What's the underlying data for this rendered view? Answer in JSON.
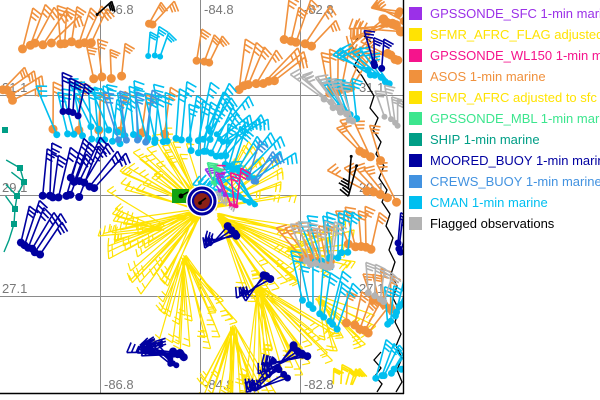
{
  "colors": {
    "sfc": "#9B30E8",
    "sfmr_flag": "#FFE303",
    "wl150": "#F5148C",
    "asos": "#F0913D",
    "sfmr": "#FFE303",
    "mbl": "#3CE68E",
    "ship": "#009E86",
    "moored": "#0000A0",
    "crews": "#4292E0",
    "cman": "#00BFF0",
    "flag": "#B3B3B3",
    "black": "#000000",
    "grid": "#8A8A8A",
    "axis_text": "#787878",
    "map_border": "#000000",
    "eye_core": "#8B2016",
    "green_box": "#12A312"
  },
  "legend": {
    "items": [
      {
        "key": "sfc",
        "label": "GPSSONDE_SFC 1-min marine"
      },
      {
        "key": "sfmr_flag",
        "label": "SFMR_AFRC_FLAG adjusted to"
      },
      {
        "key": "wl150",
        "label": "GPSSONDE_WL150 1-min mar"
      },
      {
        "key": "asos",
        "label": "ASOS 1-min marine"
      },
      {
        "key": "sfmr",
        "label": "SFMR_AFRC adjusted to sfc"
      },
      {
        "key": "mbl",
        "label": "GPSSONDE_MBL 1-min marine"
      },
      {
        "key": "ship",
        "label": "SHIP 1-min marine"
      },
      {
        "key": "moored",
        "label": "MOORED_BUOY 1-min marine"
      },
      {
        "key": "crews",
        "label": "CREWS_BUOY 1-min marine"
      },
      {
        "key": "cman",
        "label": "CMAN 1-min marine"
      },
      {
        "key": "flag",
        "label": "Flagged observations",
        "text_color": "#000000"
      }
    ]
  },
  "map": {
    "width": 403,
    "height": 393,
    "grid_v": [
      {
        "x": 100,
        "label": "-86.8"
      },
      {
        "x": 200,
        "label": "-84.8"
      },
      {
        "x": 300,
        "label": "-82.8"
      }
    ],
    "grid_h": [
      {
        "y": 95,
        "label": "31.1"
      },
      {
        "y": 195,
        "label": "29.1"
      },
      {
        "y": 296,
        "label": "27.1"
      }
    ],
    "clusters": [
      {
        "c": "asos",
        "x": 22,
        "y": 47,
        "n": 5,
        "dir": -62,
        "spread": 28,
        "len": 40,
        "dx": 7,
        "dy": -1,
        "dot": 4.5
      },
      {
        "c": "asos",
        "x": 60,
        "y": 42,
        "n": 6,
        "dir": -78,
        "spread": 30,
        "len": 38,
        "dx": 6,
        "dy": 0,
        "dot": 4.5
      },
      {
        "c": "asos",
        "x": 93,
        "y": 77,
        "n": 4,
        "dir": -95,
        "spread": 22,
        "len": 34,
        "dx": 9,
        "dy": 0,
        "dot": 4.5
      },
      {
        "c": "asos",
        "x": 2,
        "y": 88,
        "n": 4,
        "dir": -35,
        "spread": 25,
        "len": 34,
        "dx": 4,
        "dy": 4,
        "dot": 4.5
      },
      {
        "c": "asos",
        "x": 148,
        "y": 22,
        "n": 2,
        "dir": -52,
        "spread": 16,
        "len": 28,
        "dx": 6,
        "dy": 2,
        "dot": 4
      },
      {
        "c": "asos",
        "x": 238,
        "y": 88,
        "n": 7,
        "dir": -57,
        "spread": 46,
        "len": 45,
        "dx": 6,
        "dy": -1,
        "dot": 4.5
      },
      {
        "c": "asos",
        "x": 283,
        "y": 38,
        "n": 5,
        "dir": -68,
        "spread": 36,
        "len": 40,
        "dx": 7,
        "dy": 2,
        "dot": 4.5
      },
      {
        "c": "asos",
        "x": 328,
        "y": 92,
        "n": 6,
        "dir": -82,
        "spread": 40,
        "len": 40,
        "dx": 5,
        "dy": -1,
        "dot": 4
      },
      {
        "c": "asos",
        "x": 382,
        "y": 18,
        "n": 5,
        "dir": 162,
        "spread": 38,
        "len": 44,
        "dx": 5,
        "dy": 3,
        "dot": 5
      },
      {
        "c": "asos",
        "x": 386,
        "y": 52,
        "n": 4,
        "dir": -168,
        "spread": 28,
        "len": 40,
        "dx": 4,
        "dy": 3,
        "dot": 4.5
      },
      {
        "c": "asos",
        "x": 398,
        "y": 10,
        "n": 3,
        "dir": -165,
        "spread": 20,
        "len": 30,
        "dx": 2,
        "dy": 6,
        "dot": 4
      },
      {
        "c": "asos",
        "x": 358,
        "y": 150,
        "n": 4,
        "dir": -122,
        "spread": 26,
        "len": 38,
        "dx": 7,
        "dy": 3,
        "dot": 4.5
      },
      {
        "c": "asos",
        "x": 365,
        "y": 190,
        "n": 5,
        "dir": -135,
        "spread": 30,
        "len": 40,
        "dx": 8,
        "dy": 3,
        "dot": 4.5
      },
      {
        "c": "asos",
        "x": 55,
        "y": 128,
        "n": 6,
        "dir": -88,
        "spread": 10,
        "len": 44,
        "dx": 22,
        "dy": 1,
        "dot": 4.5
      },
      {
        "c": "asos",
        "x": 305,
        "y": 258,
        "n": 6,
        "dir": -115,
        "spread": 34,
        "len": 40,
        "dx": 5,
        "dy": 1,
        "dot": 4.5
      },
      {
        "c": "asos",
        "x": 350,
        "y": 243,
        "n": 5,
        "dir": -95,
        "spread": 30,
        "len": 36,
        "dx": 5,
        "dy": 2,
        "dot": 4.5
      },
      {
        "c": "asos",
        "x": 348,
        "y": 322,
        "n": 5,
        "dir": -70,
        "spread": 30,
        "len": 34,
        "dx": 5,
        "dy": 3,
        "dot": 4.5
      },
      {
        "c": "asos",
        "x": 374,
        "y": 300,
        "n": 4,
        "dir": -100,
        "spread": 24,
        "len": 32,
        "dx": 6,
        "dy": 3,
        "dot": 4
      },
      {
        "c": "asos",
        "x": 198,
        "y": 60,
        "n": 3,
        "dir": -72,
        "spread": 18,
        "len": 28,
        "dx": 6,
        "dy": 1,
        "dot": 4
      },
      {
        "c": "cman",
        "x": 58,
        "y": 134,
        "n": 9,
        "dir": -96,
        "spread": 30,
        "len": 48,
        "dx": 8,
        "dy": 1,
        "dot": 3.5
      },
      {
        "c": "cman",
        "x": 92,
        "y": 126,
        "n": 9,
        "dir": -102,
        "spread": 36,
        "len": 50,
        "dx": 8,
        "dy": 2,
        "dot": 3.5
      },
      {
        "c": "cman",
        "x": 148,
        "y": 140,
        "n": 10,
        "dir": -86,
        "spread": 40,
        "len": 52,
        "dx": 7,
        "dy": 0,
        "dot": 3.5
      },
      {
        "c": "cman",
        "x": 192,
        "y": 150,
        "n": 8,
        "dir": -70,
        "spread": 44,
        "len": 48,
        "dx": 5,
        "dy": 1,
        "dot": 3.5
      },
      {
        "c": "cman",
        "x": 226,
        "y": 164,
        "n": 8,
        "dir": -58,
        "spread": 50,
        "len": 44,
        "dx": 4,
        "dy": 2,
        "dot": 3.5
      },
      {
        "c": "cman",
        "x": 238,
        "y": 197,
        "n": 10,
        "dir": -148,
        "spread": 55,
        "len": 44,
        "dx": 2,
        "dy": 1,
        "dot": 2.5
      },
      {
        "c": "cman",
        "x": 303,
        "y": 300,
        "n": 8,
        "dir": -86,
        "spread": 36,
        "len": 45,
        "dx": 5,
        "dy": 4,
        "dot": 3.5
      },
      {
        "c": "cman",
        "x": 318,
        "y": 264,
        "n": 7,
        "dir": -96,
        "spread": 30,
        "len": 42,
        "dx": 5,
        "dy": -2,
        "dot": 3.5
      },
      {
        "c": "cman",
        "x": 388,
        "y": 324,
        "n": 6,
        "dir": -76,
        "spread": 30,
        "len": 36,
        "dx": 3,
        "dy": -4,
        "dot": 3.5
      },
      {
        "c": "cman",
        "x": 376,
        "y": 378,
        "n": 7,
        "dir": -60,
        "spread": 34,
        "len": 40,
        "dx": 5,
        "dy": -2,
        "dot": 3.5
      },
      {
        "c": "cman",
        "x": 368,
        "y": 70,
        "n": 6,
        "dir": -140,
        "spread": 34,
        "len": 40,
        "dx": 4,
        "dy": 3,
        "dot": 3.5
      },
      {
        "c": "cman",
        "x": 340,
        "y": 106,
        "n": 5,
        "dir": -112,
        "spread": 28,
        "len": 36,
        "dx": 4,
        "dy": 3,
        "dot": 3.5
      },
      {
        "c": "cman",
        "x": 148,
        "y": 56,
        "n": 3,
        "dir": -80,
        "spread": 18,
        "len": 28,
        "dx": 6,
        "dy": 1,
        "dot": 3
      },
      {
        "c": "cman",
        "x": 208,
        "y": 128,
        "n": 6,
        "dir": -46,
        "spread": 40,
        "len": 44,
        "dx": 4,
        "dy": 3,
        "dot": 3
      },
      {
        "c": "crews",
        "x": 118,
        "y": 140,
        "n": 4,
        "dir": -95,
        "spread": 24,
        "len": 46,
        "dx": 9,
        "dy": 1,
        "dot": 3.5
      },
      {
        "c": "crews",
        "x": 248,
        "y": 178,
        "n": 3,
        "dir": -60,
        "spread": 20,
        "len": 38,
        "dx": 5,
        "dy": 2,
        "dot": 3
      },
      {
        "c": "moored",
        "x": 42,
        "y": 196,
        "n": 7,
        "dir": -78,
        "spread": 18,
        "len": 48,
        "dx": 6,
        "dy": 0,
        "dot": 4
      },
      {
        "c": "moored",
        "x": 70,
        "y": 178,
        "n": 6,
        "dir": -60,
        "spread": 24,
        "len": 44,
        "dx": 5,
        "dy": 2,
        "dot": 4
      },
      {
        "c": "moored",
        "x": 20,
        "y": 243,
        "n": 6,
        "dir": -64,
        "spread": 22,
        "len": 42,
        "dx": 4,
        "dy": 2,
        "dot": 4
      },
      {
        "c": "moored",
        "x": 62,
        "y": 112,
        "n": 4,
        "dir": -86,
        "spread": 18,
        "len": 34,
        "dx": 5,
        "dy": 1,
        "dot": 3.5
      },
      {
        "c": "moored",
        "x": 172,
        "y": 352,
        "n": 6,
        "dir": 182,
        "spread": 10,
        "len": 42,
        "dx": 2,
        "dy": 1,
        "dot": 4
      },
      {
        "c": "moored",
        "x": 168,
        "y": 358,
        "n": 5,
        "dir": 215,
        "spread": 25,
        "len": 30,
        "dx": 2,
        "dy": 2,
        "dot": 3
      },
      {
        "c": "moored",
        "x": 272,
        "y": 362,
        "n": 5,
        "dir": 145,
        "spread": 30,
        "len": 38,
        "dx": 4,
        "dy": 4,
        "dot": 3.5
      },
      {
        "c": "moored",
        "x": 292,
        "y": 346,
        "n": 6,
        "dir": 148,
        "spread": 48,
        "len": 42,
        "dx": 3,
        "dy": 2,
        "dot": 4
      },
      {
        "c": "moored",
        "x": 262,
        "y": 276,
        "n": 3,
        "dir": 136,
        "spread": 24,
        "len": 34,
        "dx": 4,
        "dy": 2,
        "dot": 4
      },
      {
        "c": "moored",
        "x": 226,
        "y": 227,
        "n": 4,
        "dir": 150,
        "spread": 34,
        "len": 30,
        "dx": 4,
        "dy": 3,
        "dot": 4
      },
      {
        "c": "moored",
        "x": 372,
        "y": 64,
        "n": 3,
        "dir": -95,
        "spread": 16,
        "len": 30,
        "dx": 4,
        "dy": 3,
        "dot": 3.5
      },
      {
        "c": "moored",
        "x": 396,
        "y": 244,
        "n": 3,
        "dir": -80,
        "spread": 14,
        "len": 28,
        "dx": 3,
        "dy": 4,
        "dot": 3.5
      },
      {
        "c": "flag",
        "x": 326,
        "y": 100,
        "n": 8,
        "dir": -126,
        "spread": 36,
        "len": 40,
        "dx": 4,
        "dy": 3,
        "dot": 3.5
      },
      {
        "c": "flag",
        "x": 308,
        "y": 262,
        "n": 7,
        "dir": -96,
        "spread": 30,
        "len": 40,
        "dx": 4,
        "dy": 1,
        "dot": 3.5
      },
      {
        "c": "flag",
        "x": 370,
        "y": 294,
        "n": 4,
        "dir": -86,
        "spread": 24,
        "len": 32,
        "dx": 5,
        "dy": 2,
        "dot": 3.5
      },
      {
        "c": "flag",
        "x": 386,
        "y": 118,
        "n": 4,
        "dir": -100,
        "spread": 22,
        "len": 30,
        "dx": 4,
        "dy": 3,
        "dot": 3
      },
      {
        "c": "flag",
        "x": 203,
        "y": 199,
        "n": 3,
        "dir": -12,
        "spread": 18,
        "len": 24,
        "dx": 3,
        "dy": 2,
        "dot": 2.5
      },
      {
        "c": "wl150",
        "x": 232,
        "y": 206,
        "n": 3,
        "dir": -95,
        "spread": 28,
        "len": 38,
        "dx": 3,
        "dy": 1,
        "dot": 2
      },
      {
        "c": "sfc",
        "x": 221,
        "y": 192,
        "n": 2,
        "dir": -120,
        "spread": 14,
        "len": 24,
        "dx": 3,
        "dy": 2,
        "dot": 2
      },
      {
        "c": "mbl",
        "x": 214,
        "y": 184,
        "n": 2,
        "dir": -100,
        "spread": 12,
        "len": 20,
        "dx": 3,
        "dy": 1,
        "dot": 2
      },
      {
        "c": "black",
        "x": 98,
        "y": 16,
        "n": 1,
        "dir": -40,
        "spread": 0,
        "len": 20,
        "dx": 0,
        "dy": 0,
        "dot": 1.5
      },
      {
        "c": "black",
        "x": 352,
        "y": 158,
        "n": 2,
        "dir": 100,
        "spread": 18,
        "len": 34,
        "dx": 4,
        "dy": 8,
        "dot": 1.5
      },
      {
        "c": "sfmr",
        "x": 334,
        "y": 386,
        "n": 5,
        "dir": -78,
        "spread": 24,
        "len": 18,
        "dx": 5,
        "dy": 0,
        "dot": 0
      }
    ],
    "fans": [
      {
        "c": "sfmr",
        "x": 205,
        "y": 212,
        "a1": 195,
        "a2": 250,
        "n": 24,
        "len": 78
      },
      {
        "c": "sfmr",
        "x": 200,
        "y": 210,
        "a1": 112,
        "a2": 175,
        "n": 28,
        "len": 85
      },
      {
        "c": "sfmr",
        "x": 214,
        "y": 208,
        "a1": -70,
        "a2": -8,
        "n": 16,
        "len": 70
      },
      {
        "c": "sfmr",
        "x": 220,
        "y": 216,
        "a1": 8,
        "a2": 70,
        "n": 28,
        "len": 92
      },
      {
        "c": "sfmr",
        "x": 258,
        "y": 288,
        "a1": 30,
        "a2": 95,
        "n": 26,
        "len": 85
      },
      {
        "c": "sfmr",
        "x": 233,
        "y": 328,
        "a1": 58,
        "a2": 120,
        "n": 24,
        "len": 70
      },
      {
        "c": "sfmr",
        "x": 184,
        "y": 258,
        "a1": 45,
        "a2": 112,
        "n": 22,
        "len": 76
      },
      {
        "c": "sfmr",
        "x": 288,
        "y": 250,
        "a1": -28,
        "a2": 30,
        "n": 14,
        "len": 58
      },
      {
        "c": "sfmr",
        "x": 318,
        "y": 298,
        "a1": 18,
        "a2": 80,
        "n": 12,
        "len": 56
      },
      {
        "c": "sfmr",
        "x": 163,
        "y": 228,
        "a1": 150,
        "a2": 210,
        "n": 12,
        "len": 55
      }
    ],
    "ship_track": {
      "pts": [
        [
          20,
          168
        ],
        [
          24,
          182
        ],
        [
          17,
          196
        ],
        [
          15,
          209
        ],
        [
          14,
          224
        ],
        [
          9,
          240
        ],
        [
          4,
          252
        ]
      ],
      "dot_count": 5,
      "barb_count": 4,
      "extra_dots": [
        [
          5,
          130
        ]
      ]
    },
    "coast": [
      [
        [
          358,
          38
        ],
        [
          352,
          46
        ],
        [
          360,
          56
        ],
        [
          354,
          66
        ],
        [
          362,
          76
        ],
        [
          368,
          86
        ],
        [
          374,
          96
        ],
        [
          370,
          108
        ],
        [
          378,
          118
        ],
        [
          373,
          130
        ],
        [
          381,
          142
        ],
        [
          376,
          154
        ],
        [
          384,
          166
        ],
        [
          379,
          178
        ],
        [
          387,
          190
        ],
        [
          382,
          202
        ],
        [
          390,
          214
        ],
        [
          386,
          226
        ],
        [
          393,
          238
        ],
        [
          389,
          250
        ],
        [
          395,
          262
        ],
        [
          391,
          274
        ],
        [
          397,
          286
        ],
        [
          393,
          298
        ],
        [
          399,
          310
        ],
        [
          395,
          322
        ],
        [
          401,
          334
        ],
        [
          396,
          346
        ],
        [
          402,
          358
        ],
        [
          397,
          370
        ],
        [
          402,
          382
        ],
        [
          396,
          392
        ]
      ],
      [
        [
          381,
          352
        ],
        [
          374,
          360
        ],
        [
          381,
          368
        ],
        [
          375,
          376
        ],
        [
          382,
          384
        ],
        [
          377,
          392
        ]
      ],
      [
        [
          370,
          30
        ],
        [
          364,
          36
        ],
        [
          371,
          42
        ]
      ]
    ],
    "markers": {
      "green_box": {
        "x": 172,
        "y": 189,
        "w": 17,
        "h": 14
      },
      "eye": {
        "cx": 202,
        "cy": 201,
        "halo_r": 16,
        "outer_r": 13,
        "inner_r": 9,
        "core_r": 6.5
      }
    }
  }
}
